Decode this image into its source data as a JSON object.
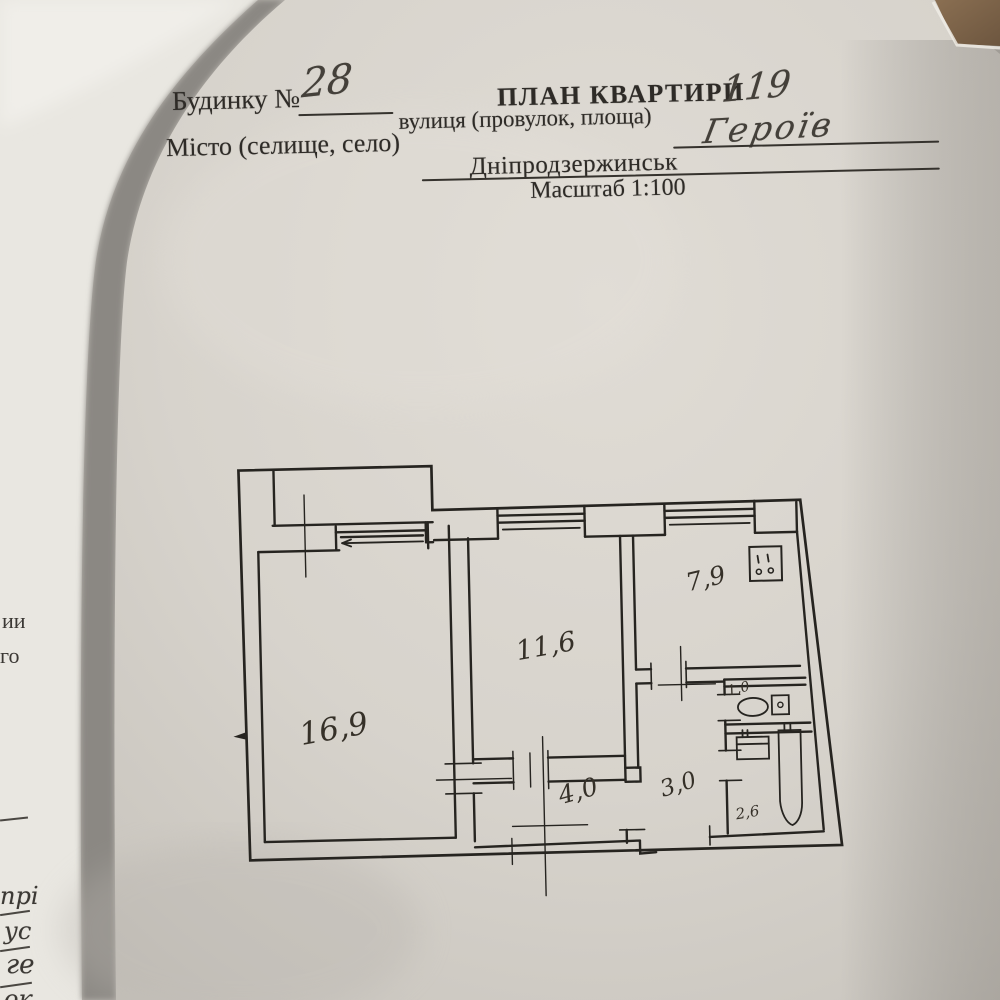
{
  "header": {
    "building_label": "Будинку №",
    "building_number": "28",
    "title": "ПЛАН КВАРТИРИ",
    "apartment_number": "119",
    "street_label": "вулиця (провулок, площа)",
    "street_value": "Героїв",
    "city_label": "Місто (селище, село)",
    "city_value": "Дніпродзержинськ",
    "scale_text": "Масштаб 1:100"
  },
  "plan": {
    "scale": "1:100",
    "rooms": [
      {
        "id": "living-room",
        "area": "16,9"
      },
      {
        "id": "bedroom",
        "area": "11,6"
      },
      {
        "id": "kitchen",
        "area": "7,9"
      },
      {
        "id": "hallway",
        "area": "4,0"
      },
      {
        "id": "corridor",
        "area": "3,0"
      },
      {
        "id": "wc",
        "area": "1,0"
      },
      {
        "id": "bathroom",
        "area": "2,6"
      }
    ],
    "fixtures": [
      "stove-icon",
      "toilet-icon",
      "sink-icon",
      "bathtub-icon"
    ],
    "windows_count": "3"
  },
  "side_fragments": {
    "f1": "ии",
    "f2": "го",
    "f3": "прі",
    "f4": "ус",
    "f5": "ге",
    "f6": "ок"
  },
  "colors": {
    "paper": "#dcd8d1",
    "under_paper": "#e9e7e1",
    "shadow_band": "#8b8883",
    "table_brown": "#826749",
    "ink": "#262420"
  }
}
